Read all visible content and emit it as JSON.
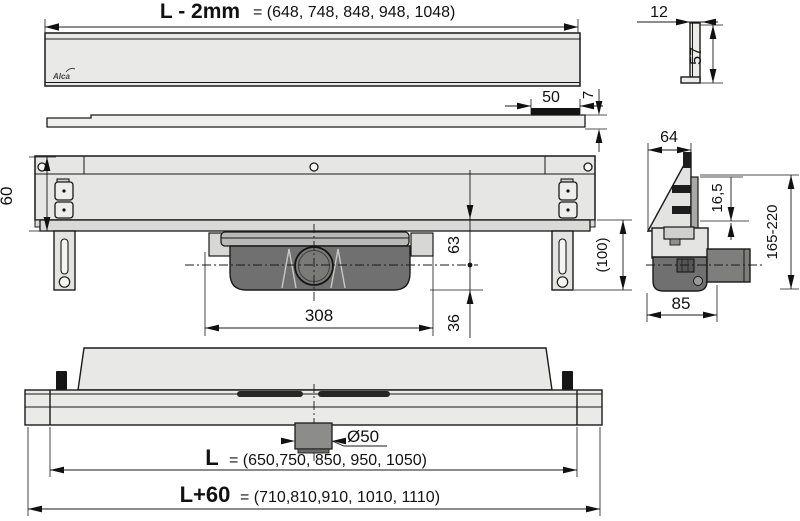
{
  "brand": "Alca",
  "dim": {
    "grate_length_label": "L - 2mm",
    "grate_length_values": "= (648, 748, 848, 948, 1048)",
    "profile_width": "12",
    "profile_height": "57",
    "strip_length": "50",
    "plate_thickness": "7",
    "body_height": "60",
    "leg_height": "(100)",
    "top_to_axis": "63",
    "axis_to_bottom": "36",
    "trap_width": "308",
    "section_width": "64",
    "plate_offset": "16,5",
    "height_range": "165-220",
    "trap_depth": "85",
    "outlet_diameter": "Ø50",
    "channel_length_label": "L",
    "channel_length_values": "= (650,750, 850, 950, 1050)",
    "total_length_label": "L+60",
    "total_length_values": "= (710,810,910, 1010, 1110)"
  }
}
